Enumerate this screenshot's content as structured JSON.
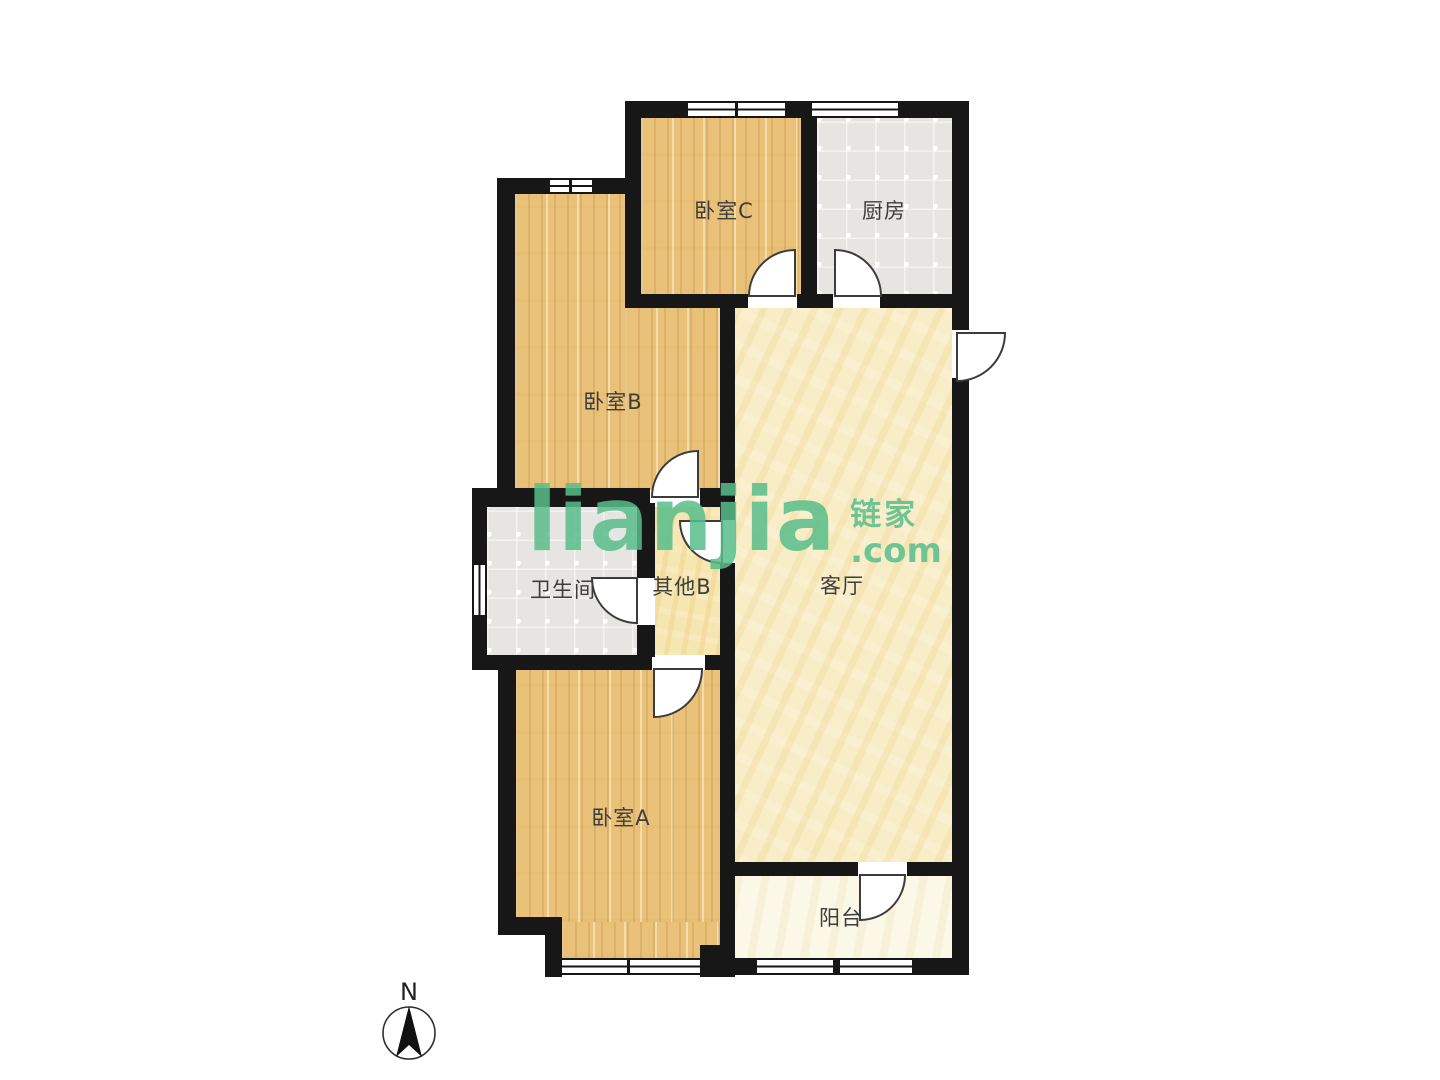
{
  "watermark": {
    "brand": "lianjia",
    "domain_suffix": ".com",
    "brand_cn": "链家",
    "color": "#58be8b"
  },
  "compass": {
    "north_label": "N"
  },
  "rooms": [
    {
      "id": "bedroom-c",
      "label": "卧室C",
      "floor_type": "wood"
    },
    {
      "id": "kitchen",
      "label": "厨房",
      "floor_type": "tile"
    },
    {
      "id": "bedroom-b",
      "label": "卧室B",
      "floor_type": "wood"
    },
    {
      "id": "bathroom",
      "label": "卫生间",
      "floor_type": "tile"
    },
    {
      "id": "other-b",
      "label": "其他B",
      "floor_type": "screed"
    },
    {
      "id": "living-room",
      "label": "客厅",
      "floor_type": "screed"
    },
    {
      "id": "bedroom-a",
      "label": "卧室A",
      "floor_type": "wood"
    },
    {
      "id": "balcony",
      "label": "阳台",
      "floor_type": "screed"
    }
  ],
  "colors": {
    "wall": "#171717",
    "wood_floor": "#eac179",
    "tile_floor": "#e6e5e2",
    "living_floor": "#f8edc6",
    "hall_floor": "#f6e6b2",
    "balcony_floor": "#fbf8e7",
    "watermark_green": "#58be8b",
    "label_text": "#3d3d3d"
  }
}
